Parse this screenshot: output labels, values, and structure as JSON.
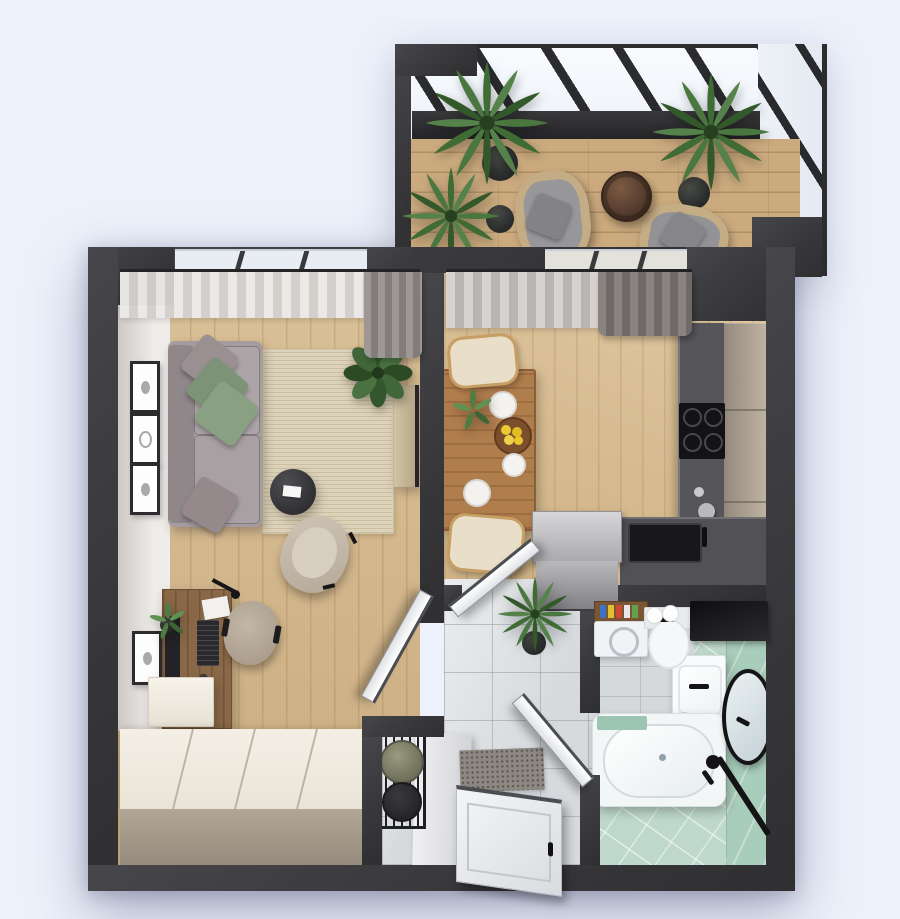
{
  "scene": {
    "title": "3D top-down floor plan render of a one-room apartment with glazed balcony",
    "view": "top-down axonometric interior render",
    "background_color": "#edf1fb",
    "wall_color": "#3a3a3d"
  },
  "palette": {
    "wood_floor": "#d6b98c",
    "balcony_decking": "#cbaa7e",
    "hall_marble": "#dadde0",
    "bath_floor_mint": "#bed9cc",
    "bath_wall_mint": "#a8cdbb",
    "rug_beige": "#ddd2ba",
    "sofa_gray": "#a49c9e",
    "pillow_green": "#82987b",
    "kitchen_worktop": "#55555a",
    "kitchen_cabinet": "#b3a696",
    "dining_wood": "#b07d4d",
    "wardrobe_cream": "#f1ecdf",
    "curtain_gray": "#8a8480",
    "plant_green": "#3f6b35",
    "fixture_black": "#141416",
    "door_white": "#f2f3f5"
  },
  "rooms": {
    "balcony": {
      "label": "Balcony terrace with glass pergola",
      "furniture": {
        "pergola": {
          "label": "Glass pergola roof with black beams"
        },
        "decking": {
          "label": "Wood plank decking"
        },
        "palm_large": {
          "label": "Large potted palm (left)"
        },
        "palm_small": {
          "label": "Small potted palm (front left)"
        },
        "palm_right": {
          "label": "Potted palm (right)"
        },
        "chair_left": {
          "label": "Rattan armchair with gray cushions (left)"
        },
        "chair_right": {
          "label": "Rattan armchair with gray cushions (right)"
        },
        "side_table": {
          "label": "Round dark-wood side table"
        }
      }
    },
    "living_room": {
      "label": "Living room with workspace",
      "furniture": {
        "window": {
          "label": "Panoramic window"
        },
        "sheer_curtain": {
          "label": "Sheer curtain"
        },
        "drape": {
          "label": "Gray drape"
        },
        "art_1": {
          "label": "Framed artwork"
        },
        "art_2": {
          "label": "Framed artwork"
        },
        "art_3": {
          "label": "Framed artwork"
        },
        "art_desk": {
          "label": "Framed artwork above desk"
        },
        "sofa": {
          "label": "Gray fabric sofa with green and gray pillows"
        },
        "rug": {
          "label": "Beige woven area rug"
        },
        "coffee_table": {
          "label": "Round black coffee table with white tray"
        },
        "armchair": {
          "label": "Beige lounge armchair"
        },
        "ficus": {
          "label": "Potted ficus plant"
        },
        "media_panel": {
          "label": "Slim media console on partition wall"
        },
        "desk": {
          "label": "Wooden desk with monitor, keyboard and lamp"
        },
        "desk_chair": {
          "label": "Upholstered desk chair"
        },
        "floating_cabinet": {
          "label": "White floating cabinet"
        },
        "wardrobe": {
          "label": "Large cream wardrobe"
        },
        "door": {
          "label": "White interior door, open"
        }
      }
    },
    "kitchen": {
      "label": "Kitchen and dining area",
      "furniture": {
        "window": {
          "label": "Window to balcony"
        },
        "sheer_curtain": {
          "label": "Sheer curtain"
        },
        "drape": {
          "label": "Gray drape"
        },
        "dining_table": {
          "label": "Wooden dining table with plates, teapot and bowl of lemons"
        },
        "chair_top": {
          "label": "Cream dining chair"
        },
        "chair_bottom": {
          "label": "Cream dining chair"
        },
        "tall_cabinets": {
          "label": "Beige tall cabinet run"
        },
        "worktop": {
          "label": "Dark worktop along right wall"
        },
        "cooktop": {
          "label": "Black gas cooktop"
        },
        "counter": {
          "label": "Dark counter with sink"
        },
        "sink": {
          "label": "Black kitchen sink with faucet"
        },
        "island": {
          "label": "Gray base cabinet"
        },
        "kettle": {
          "label": "Kettle and cups on worktop"
        },
        "door": {
          "label": "White door to hallway, open"
        }
      }
    },
    "hallway": {
      "label": "Entrance hallway",
      "furniture": {
        "plant": {
          "label": "Potted palm"
        },
        "doormat": {
          "label": "Dark doormat"
        },
        "entry_door": {
          "label": "White entrance door"
        },
        "bench": {
          "label": "Light hallway bench"
        },
        "basket_stand": {
          "label": "Black stand with round baskets"
        }
      }
    },
    "bathroom": {
      "label": "Bathroom",
      "furniture": {
        "washing_machine": {
          "label": "Washing machine"
        },
        "shelf": {
          "label": "Wooden shelf with toiletries"
        },
        "toilet": {
          "label": "Toilet with paper rolls"
        },
        "dark_cabinet": {
          "label": "Black wall cabinet"
        },
        "basin": {
          "label": "White washbasin with black faucet"
        },
        "mirror": {
          "label": "Oval black-framed mirror"
        },
        "bathtub": {
          "label": "White bathtub"
        },
        "shower": {
          "label": "Black shower set"
        }
      }
    }
  }
}
